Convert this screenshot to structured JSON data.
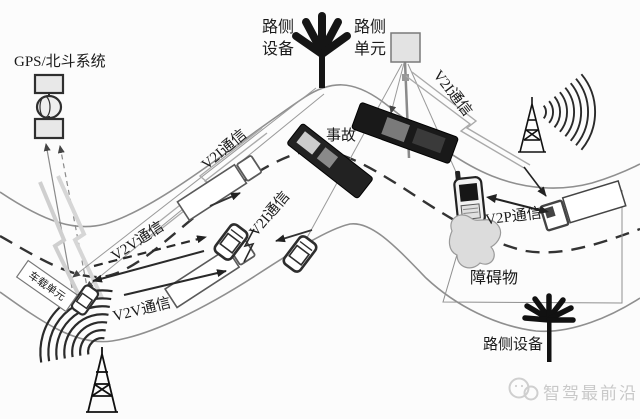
{
  "diagram": {
    "gps_system_label": "GPS/北斗系统",
    "roadside_equipment_top": {
      "line1": "路侧",
      "line2": "设备"
    },
    "roadside_unit": {
      "line1": "路侧",
      "line2": "单元"
    },
    "v2i_label": "V2I通信",
    "v2v_label": "V2V通信",
    "v2p_label": "V2P通信",
    "accident_label": "事故",
    "onboard_unit_label": "车载单元",
    "obstacle_label": "障碍物",
    "roadside_equipment_bottom": "路侧设备",
    "watermark": "智驾最前沿",
    "colors": {
      "background": "#fcfcfc",
      "road_edge": "#8f8f8f",
      "center_line": "#333333",
      "dark_element": "#1a1a1a",
      "light_fill": "#e6e6e6",
      "obstacle_fill": "#dcdcdc",
      "watermark_gray": "#c9c9c9"
    }
  }
}
